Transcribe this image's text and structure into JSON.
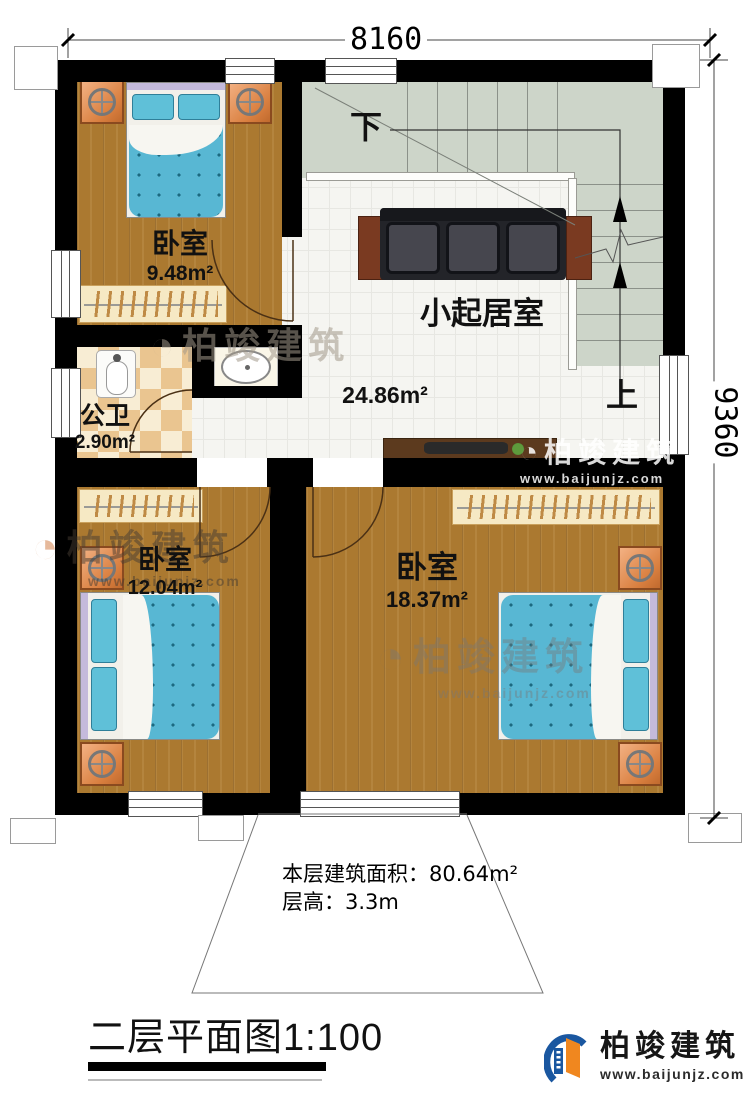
{
  "dimensions": {
    "top": "8160",
    "right": "9360"
  },
  "rooms": [
    {
      "name": "卧室",
      "area": "9.48m²"
    },
    {
      "name": "公卫",
      "area": "2.90m²"
    },
    {
      "name": "小起居室",
      "area": "24.86m²"
    },
    {
      "name": "卧室",
      "area": "12.04m²"
    },
    {
      "name": "卧室",
      "area": "18.37m²"
    }
  ],
  "stairs": {
    "down_label": "下",
    "up_label": "上"
  },
  "notes": {
    "floor_area": "本层建筑面积：80.64m²",
    "floor_height": "层高：3.3m"
  },
  "title": {
    "text": "二层平面图",
    "scale": "1:100"
  },
  "brand": {
    "name": "柏竣建筑",
    "url": "www.baijunjz.com"
  },
  "watermark": {
    "name": "柏竣建筑",
    "url": "www.baijunjz.com"
  },
  "colors": {
    "wall": "#000000",
    "wood_floor": "#ab7930",
    "bed_teal": "#58b7d3",
    "tile": "#f5f5f1",
    "stair": "#cdd5c9",
    "checker_tan": "#eac590",
    "brand_blue": "#1a57a0",
    "brand_orange": "#f0871f"
  }
}
